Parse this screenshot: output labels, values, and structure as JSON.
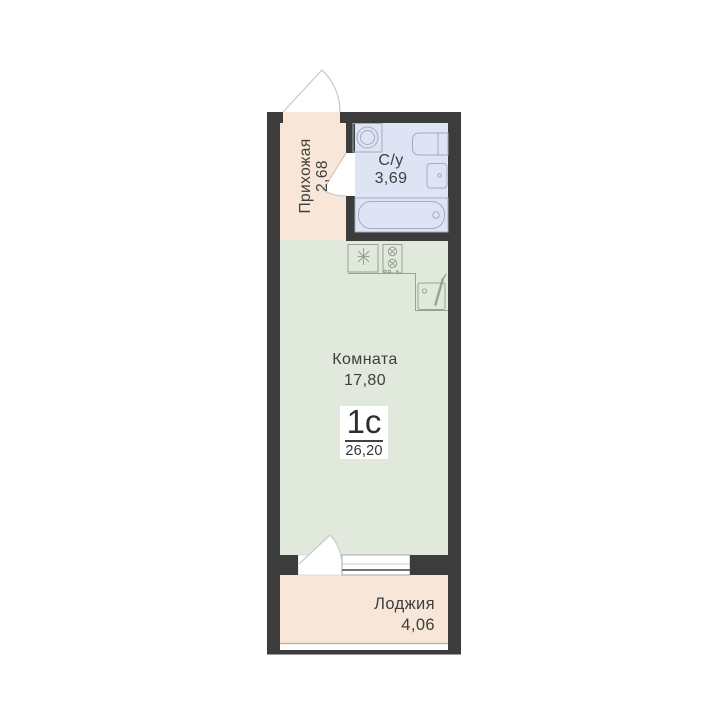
{
  "plan": {
    "unit_badge": {
      "type": "1с",
      "total_area": "26,20"
    },
    "rooms": {
      "hallway": {
        "name": "Прихожая",
        "area": "2,68"
      },
      "bathroom": {
        "name": "С/у",
        "area": "3,69"
      },
      "room": {
        "name": "Комната",
        "area": "17,80"
      },
      "loggia": {
        "name": "Лоджия",
        "area": "4,06"
      }
    },
    "colors": {
      "wall": "#3c3c3c",
      "hallway_floor": "#f8e7d8",
      "bathroom_floor": "#dee4f4",
      "room_floor": "#e0e9db",
      "loggia_floor": "#f8e7d8",
      "fixture_stroke_bath": "#a5abbe",
      "fixture_stroke_kitchen": "#99a294",
      "door_arc_stroke": "#c9c9c9",
      "window_frame": "#a9a9a9",
      "loggia_glazing": "#b7b0a6"
    },
    "icons": [
      "entry-door-swing",
      "bathroom-door-swing",
      "balcony-door-swing",
      "window",
      "washing-machine",
      "toilet",
      "washbasin",
      "bathtub",
      "fridge",
      "stove",
      "kitchen-sink"
    ]
  }
}
